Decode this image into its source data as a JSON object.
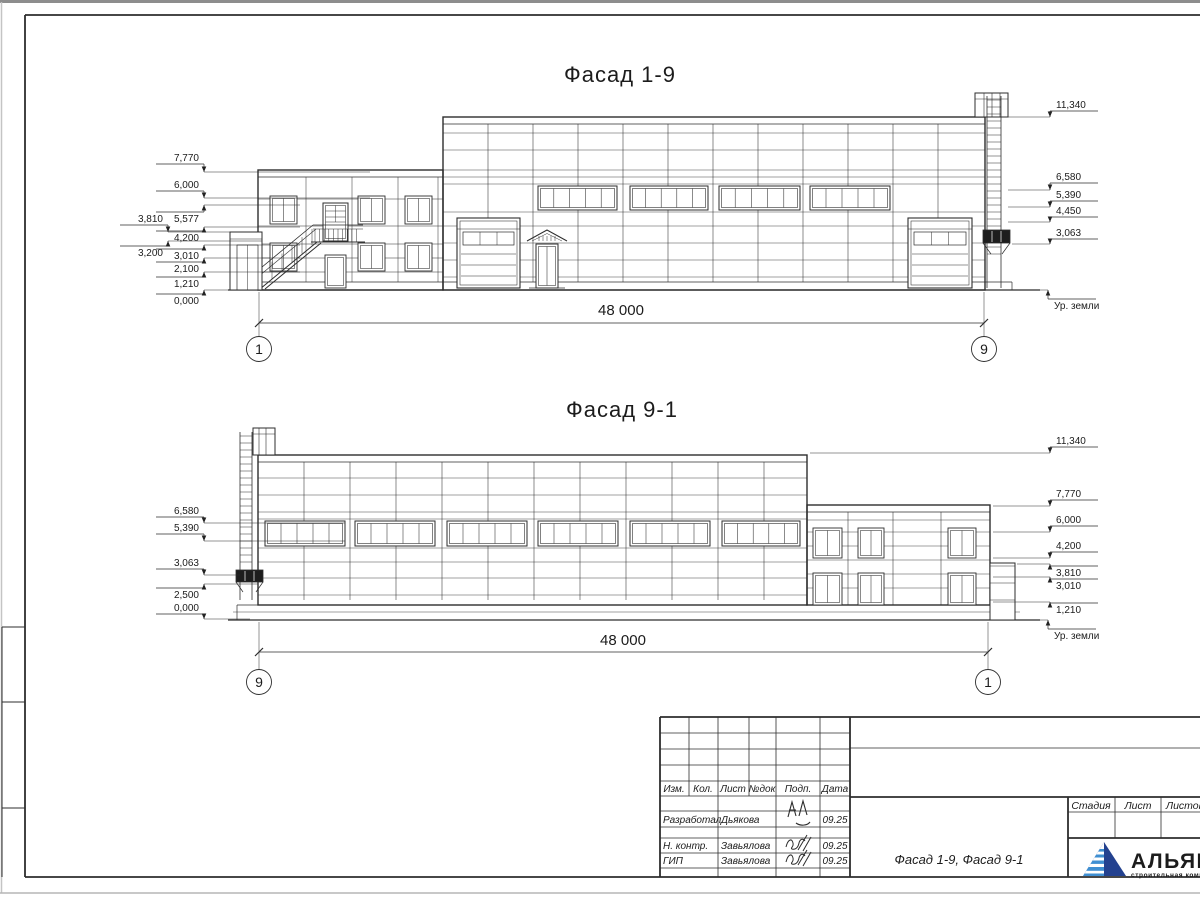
{
  "sheet": {
    "facades": {
      "f1": {
        "title": "Фасад 1-9",
        "dimension": "48 000",
        "axis_left": "1",
        "axis_right": "9",
        "marks_left": [
          {
            "v": "7,770",
            "tx": 199,
            "ty": 161,
            "ax": 204,
            "y": 172,
            "lx": 370,
            "dir": "down",
            "anchor": "end"
          },
          {
            "v": "6,000",
            "tx": 199,
            "ty": 188,
            "ax": 204,
            "y": 198,
            "lx": 370,
            "dir": "down",
            "anchor": "end"
          },
          {
            "v": "5,577",
            "tx": 199,
            "ty": 222,
            "ax": 204,
            "y": 205,
            "lx": 300,
            "dir": "up",
            "anchor": "end"
          },
          {
            "v": "3,810",
            "tx": 163,
            "ty": 222,
            "ax": 168,
            "y": 232,
            "lx": 262,
            "dir": "down",
            "anchor": "end"
          },
          {
            "v": "4,200",
            "tx": 199,
            "ty": 241,
            "ax": 204,
            "y": 227,
            "lx": 300,
            "dir": "up",
            "anchor": "end"
          },
          {
            "v": "3,200",
            "tx": 163,
            "ty": 256,
            "ax": 168,
            "y": 241,
            "lx": 262,
            "dir": "up",
            "anchor": "end"
          },
          {
            "v": "3,010",
            "tx": 199,
            "ty": 259,
            "ax": 204,
            "y": 245,
            "lx": 300,
            "dir": "up",
            "anchor": "end"
          },
          {
            "v": "2,100",
            "tx": 199,
            "ty": 272,
            "ax": 204,
            "y": 258,
            "lx": 300,
            "dir": "up",
            "anchor": "end"
          },
          {
            "v": "1,210",
            "tx": 199,
            "ty": 287,
            "ax": 204,
            "y": 272,
            "lx": 300,
            "dir": "up",
            "anchor": "end"
          },
          {
            "v": "0,000",
            "tx": 199,
            "ty": 304,
            "ax": 204,
            "y": 290,
            "lx": 258,
            "dir": "up",
            "anchor": "end"
          }
        ],
        "marks_right": [
          {
            "v": "11,340",
            "tx": 1056,
            "ty": 108,
            "ax": 1050,
            "y": 117,
            "lx": 1008,
            "dir": "down",
            "anchor": "start"
          },
          {
            "v": "6,580",
            "tx": 1056,
            "ty": 180,
            "ax": 1050,
            "y": 190,
            "lx": 1008,
            "dir": "down",
            "anchor": "start"
          },
          {
            "v": "5,390",
            "tx": 1056,
            "ty": 198,
            "ax": 1050,
            "y": 207,
            "lx": 1008,
            "dir": "down",
            "anchor": "start"
          },
          {
            "v": "4,450",
            "tx": 1056,
            "ty": 214,
            "ax": 1050,
            "y": 222,
            "lx": 1008,
            "dir": "down",
            "anchor": "start"
          },
          {
            "v": "3,063",
            "tx": 1056,
            "ty": 236,
            "ax": 1050,
            "y": 244,
            "lx": 1012,
            "dir": "down",
            "anchor": "start"
          },
          {
            "v": "Ур. земли",
            "tx": 1054,
            "ty": 309,
            "ax": 1048,
            "y": 290,
            "lx": 1013,
            "dir": "up",
            "anchor": "start"
          }
        ]
      },
      "f2": {
        "title": "Фасад 9-1",
        "dimension": "48 000",
        "axis_left": "9",
        "axis_right": "1",
        "marks_left": [
          {
            "v": "6,580",
            "tx": 199,
            "ty": 514,
            "ax": 204,
            "y": 523,
            "lx": 345,
            "dir": "down",
            "anchor": "end"
          },
          {
            "v": "5,390",
            "tx": 199,
            "ty": 531,
            "ax": 204,
            "y": 541,
            "lx": 345,
            "dir": "down",
            "anchor": "end"
          },
          {
            "v": "3,063",
            "tx": 199,
            "ty": 566,
            "ax": 204,
            "y": 575,
            "lx": 240,
            "dir": "down",
            "anchor": "end"
          },
          {
            "v": "2,500",
            "tx": 199,
            "ty": 598,
            "ax": 204,
            "y": 584,
            "lx": 258,
            "dir": "up",
            "anchor": "end"
          },
          {
            "v": "0,000",
            "tx": 199,
            "ty": 611,
            "ax": 204,
            "y": 619,
            "lx": 250,
            "dir": "down",
            "anchor": "end"
          }
        ],
        "marks_right": [
          {
            "v": "11,340",
            "tx": 1056,
            "ty": 444,
            "ax": 1050,
            "y": 453,
            "lx": 810,
            "dir": "down",
            "anchor": "start"
          },
          {
            "v": "7,770",
            "tx": 1056,
            "ty": 497,
            "ax": 1050,
            "y": 506,
            "lx": 993,
            "dir": "down",
            "anchor": "start"
          },
          {
            "v": "6,000",
            "tx": 1056,
            "ty": 523,
            "ax": 1050,
            "y": 532,
            "lx": 993,
            "dir": "down",
            "anchor": "start"
          },
          {
            "v": "4,200",
            "tx": 1056,
            "ty": 549,
            "ax": 1050,
            "y": 558,
            "lx": 993,
            "dir": "down",
            "anchor": "start"
          },
          {
            "v": "3,810",
            "tx": 1056,
            "ty": 576,
            "ax": 1050,
            "y": 564,
            "lx": 1017,
            "dir": "up",
            "anchor": "start"
          },
          {
            "v": "3,010",
            "tx": 1056,
            "ty": 589,
            "ax": 1050,
            "y": 577,
            "lx": 993,
            "dir": "up",
            "anchor": "start"
          },
          {
            "v": "1,210",
            "tx": 1056,
            "ty": 613,
            "ax": 1050,
            "y": 602,
            "lx": 993,
            "dir": "up",
            "anchor": "start"
          },
          {
            "v": "Ур. земли",
            "tx": 1054,
            "ty": 639,
            "ax": 1048,
            "y": 620,
            "lx": 1017,
            "dir": "up",
            "anchor": "start"
          }
        ]
      }
    },
    "titleblock": {
      "revision_header": [
        "Изм.",
        "Кол.",
        "Лист",
        "№док",
        "Подп.",
        "Дата"
      ],
      "signature_rows": [
        {
          "role": "Разработал",
          "name": "Дьякова",
          "date": "09.25"
        },
        {
          "role": "Н. контр.",
          "name": "Завьялова",
          "date": "09.25"
        },
        {
          "role": "ГИП",
          "name": "Завьялова",
          "date": "09.25"
        }
      ],
      "stage_header": [
        "Стадия",
        "Лист",
        "Листов"
      ],
      "doc_title": "Фасад 1-9, Фасад 9-1"
    },
    "logo": {
      "name": "АЛЬЯНС",
      "subtitle": "строительная компания",
      "color_dark": "#23418f",
      "color_mid": "#2b3990",
      "color_light": "#3f8fd2"
    }
  }
}
